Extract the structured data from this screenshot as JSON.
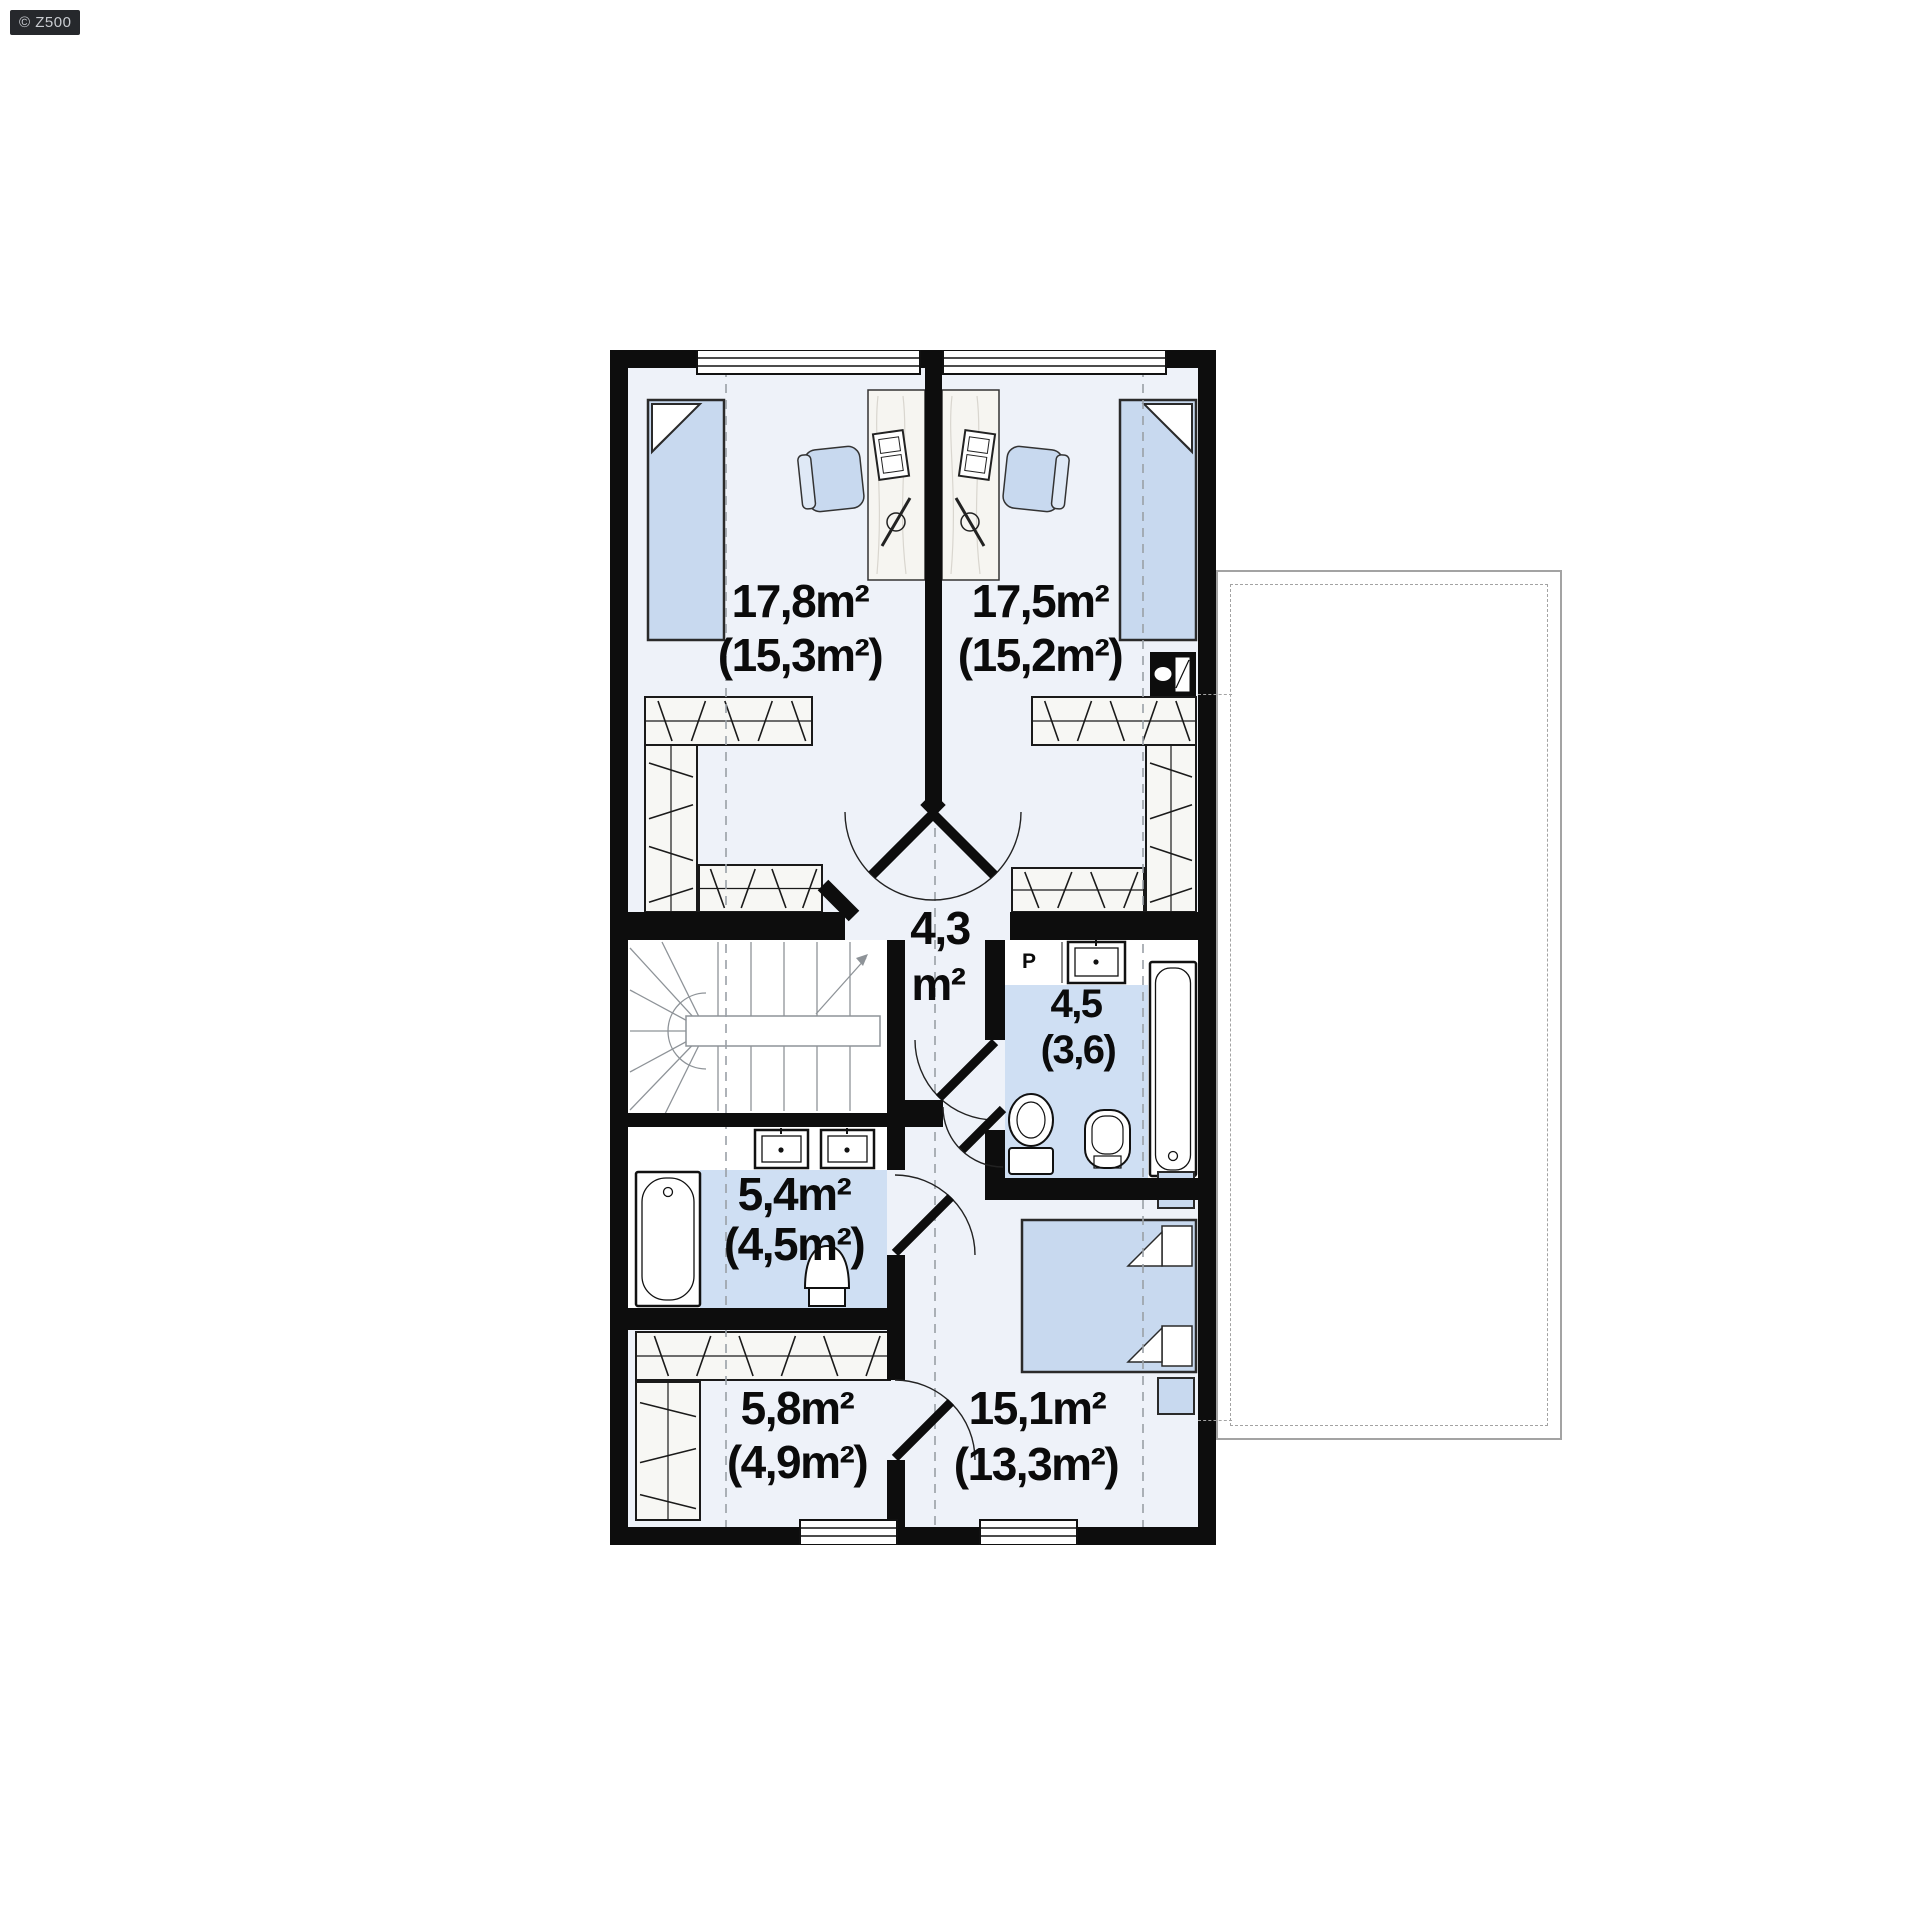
{
  "watermark": {
    "label": "© Z500"
  },
  "plan": {
    "rooms": [
      {
        "id": "bedroom-left",
        "line1": "17,8m²",
        "line2": "(15,3m²)"
      },
      {
        "id": "bedroom-right",
        "line1": "17,5m²",
        "line2": "(15,2m²)"
      },
      {
        "id": "hall",
        "line1": "4,3",
        "line2": "m²"
      },
      {
        "id": "bathroom-small",
        "line1": "4,5",
        "line2": "(3,6)"
      },
      {
        "id": "bathroom",
        "line1": "5,4m²",
        "line2": "(4,5m²)"
      },
      {
        "id": "wardrobe",
        "line1": "5,8m²",
        "line2": "(4,9m²)"
      },
      {
        "id": "bedroom-master",
        "line1": "15,1m²",
        "line2": "(13,3m²)"
      }
    ],
    "appliances": {
      "washer_label": "P"
    }
  },
  "colors": {
    "wall": "#0d0d0d",
    "floor": "#eef2f9",
    "furniture": "#c8d9ef",
    "bath_floor": "#cfdff3",
    "dash_line": "#9aa0a6"
  }
}
